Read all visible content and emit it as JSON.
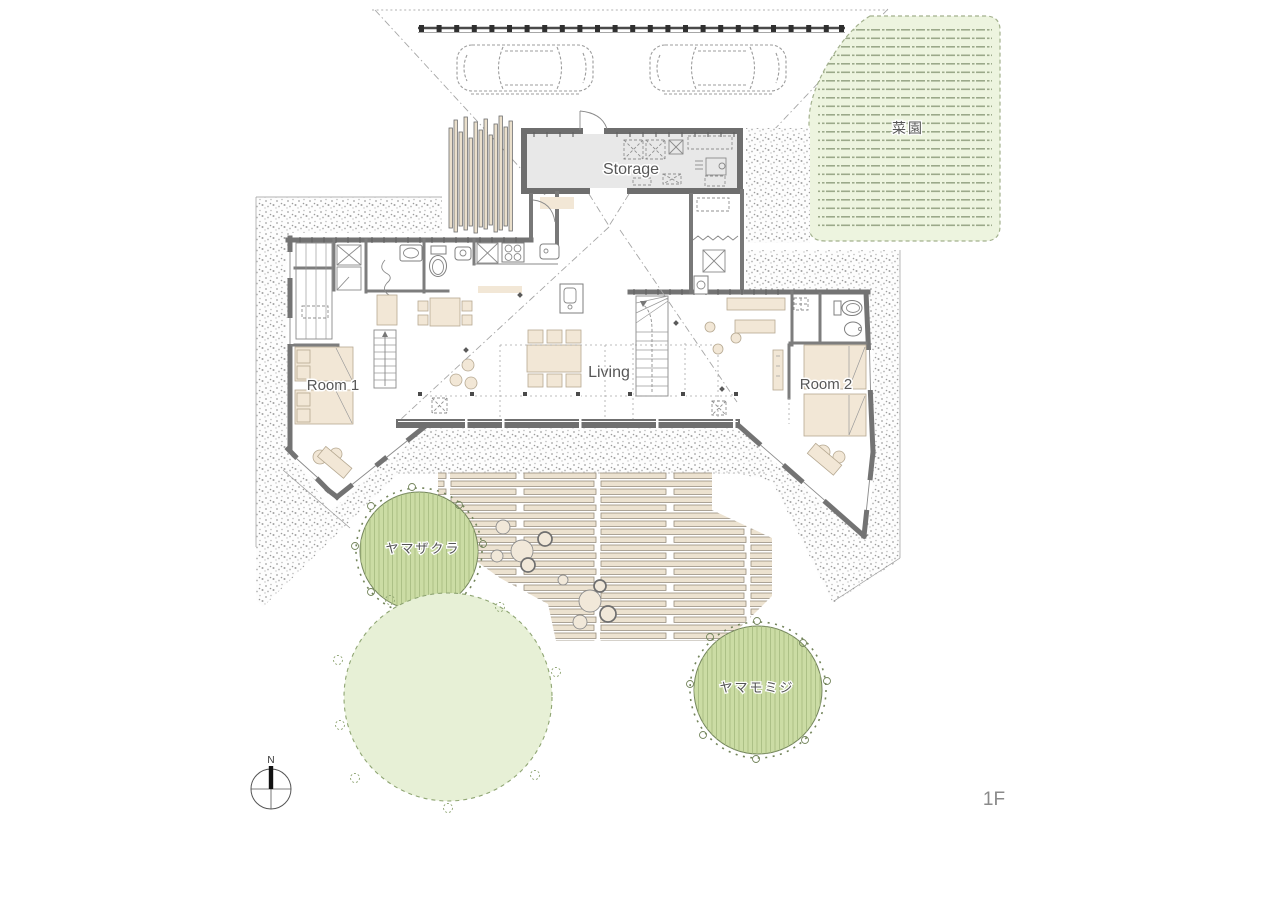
{
  "labels": {
    "storage": "Storage",
    "living": "Living",
    "room1": "Room 1",
    "room2": "Room 2",
    "vegetable_garden": "菜園",
    "tree_mountain_cherry": "ヤマザクラ",
    "tree_mountain_maple": "ヤマモミジ",
    "floor": "1F",
    "compass_north": "N"
  },
  "colors": {
    "wall_gray": "#737373",
    "storage_floor": "#e8e8e8",
    "furniture_beige": "#f2e7d6",
    "plank_beige": "#ece2d0",
    "tree_green": "#cbdca4",
    "tree_hatch_green": "#a9be82",
    "tree_light_green": "#e7f0d6",
    "garden_green": "#edf4df",
    "garden_row_green": "#9ba98a",
    "gravel_dot_gray": "#a3a3a3",
    "deck_gray": "#6f6f6f",
    "label_gray": "#575757"
  }
}
